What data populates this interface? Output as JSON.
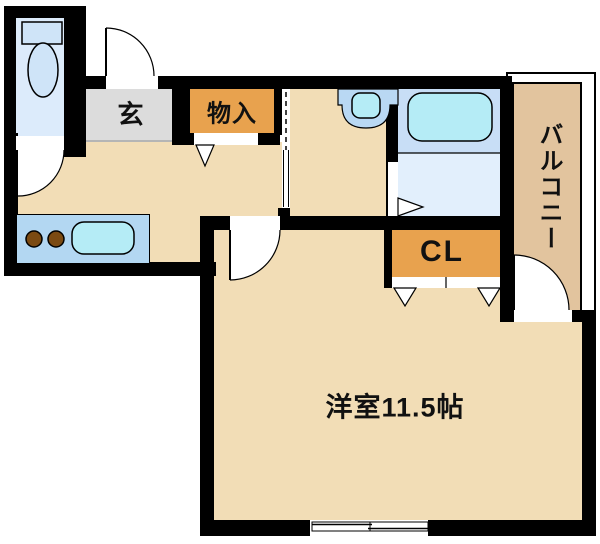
{
  "plan": {
    "type": "apartment-floorplan",
    "labels": {
      "entrance": "玄",
      "storage": "物入",
      "closet": "CL",
      "main_room": "洋室11.5帖",
      "balcony": "バルコニー"
    },
    "colors": {
      "background": "#ffffff",
      "wall": "#000000",
      "floor_tan": "#f2ddb6",
      "balcony_tan": "#e2c49e",
      "accent_orange": "#e8a24e",
      "genkan_gray": "#dcdcdc",
      "toilet_blue": "#dcebfb",
      "bath_floor": "#e2effc",
      "tub_band": "#c8def6",
      "fixture_cyan": "#b5ecf6",
      "counter_blue": "#b3d7f2",
      "fixture_blue": "#cfe4f8",
      "vanity_blue": "#b9d8f3",
      "burner_brown": "#7b4a12"
    }
  }
}
